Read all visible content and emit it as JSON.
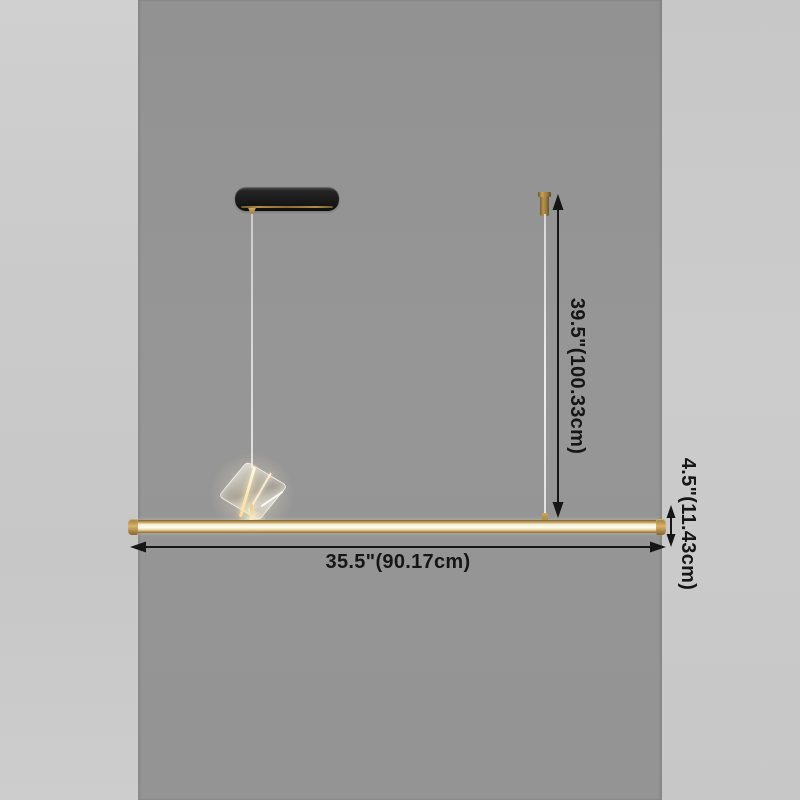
{
  "diagram": {
    "dimensions": {
      "drop_height": "39.5\"(100.33cm)",
      "bar_offset_height": "4.5\"(11.43cm)",
      "bar_width": "35.5\"(90.17cm)"
    },
    "colors": {
      "wall_center": "#959595",
      "wall_sides": "#cacaca",
      "brass": "#c9a55c",
      "led_stripe": "#fffdf4",
      "canopy_black": "#1a1a1a",
      "annotation_ink": "#161616"
    }
  }
}
